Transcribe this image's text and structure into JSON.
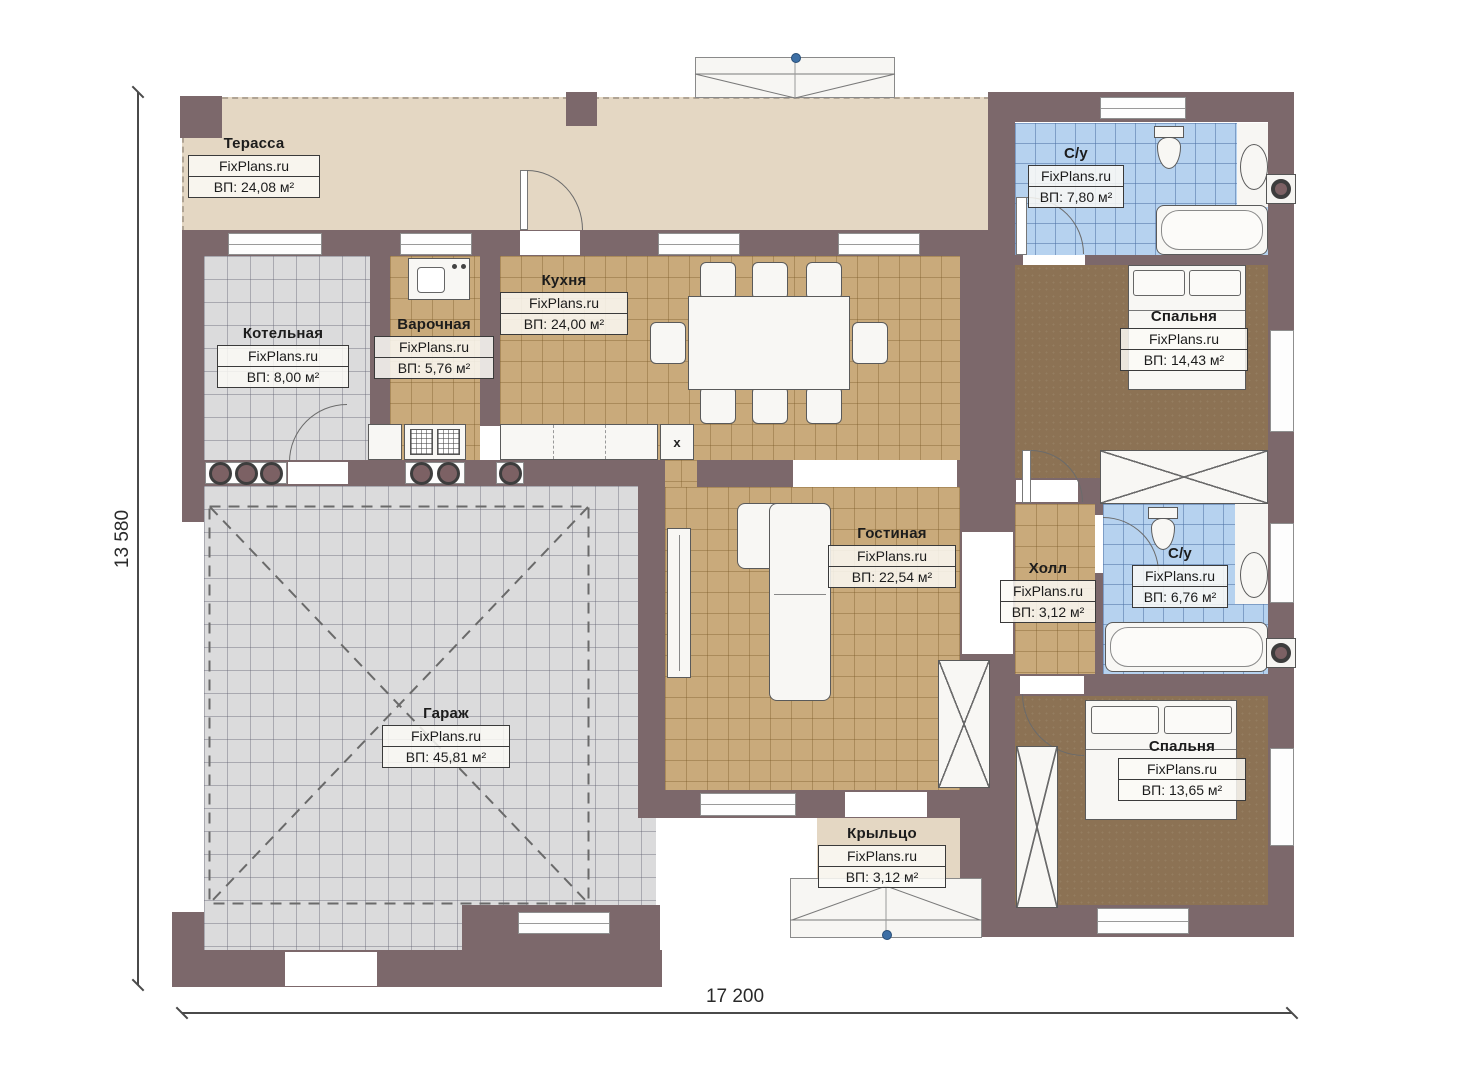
{
  "plan": {
    "brand": "FixPlans.ru",
    "dimensions": {
      "width_label": "17 200",
      "height_label": "13 580"
    },
    "rooms": {
      "terrace": {
        "name": "Терасса",
        "area": "ВП: 24,08 м²"
      },
      "boiler": {
        "name": "Котельная",
        "area": "ВП: 8,00 м²"
      },
      "cooking": {
        "name": "Варочная",
        "area": "ВП: 5,76 м²"
      },
      "kitchen": {
        "name": "Кухня",
        "area": "ВП: 24,00 м²"
      },
      "bath_top": {
        "name": "С/у",
        "area": "ВП: 7,80 м²"
      },
      "bedroom_top": {
        "name": "Спальня",
        "area": "ВП: 14,43 м²"
      },
      "living": {
        "name": "Гостиная",
        "area": "ВП: 22,54 м²"
      },
      "hall": {
        "name": "Холл",
        "area": "ВП: 3,12 м²"
      },
      "bath_mid": {
        "name": "С/у",
        "area": "ВП: 6,76 м²"
      },
      "garage": {
        "name": "Гараж",
        "area": "ВП: 45,81 м²"
      },
      "bedroom_bottom": {
        "name": "Спальня",
        "area": "ВП: 13,65 м²"
      },
      "porch": {
        "name": "Крыльцо",
        "area": "ВП: 3,12 м²"
      }
    },
    "marks": {
      "counter_x": "x"
    },
    "colors": {
      "wall": "#7c686b",
      "terrace": "#e4d7c3",
      "tile_tan": "#c9aa7b",
      "tile_blue": "#b6d2ef",
      "tile_gray": "#dbdbdc",
      "floor_brown": "#8c7254",
      "marker_dot": "#3d6fa5"
    }
  }
}
